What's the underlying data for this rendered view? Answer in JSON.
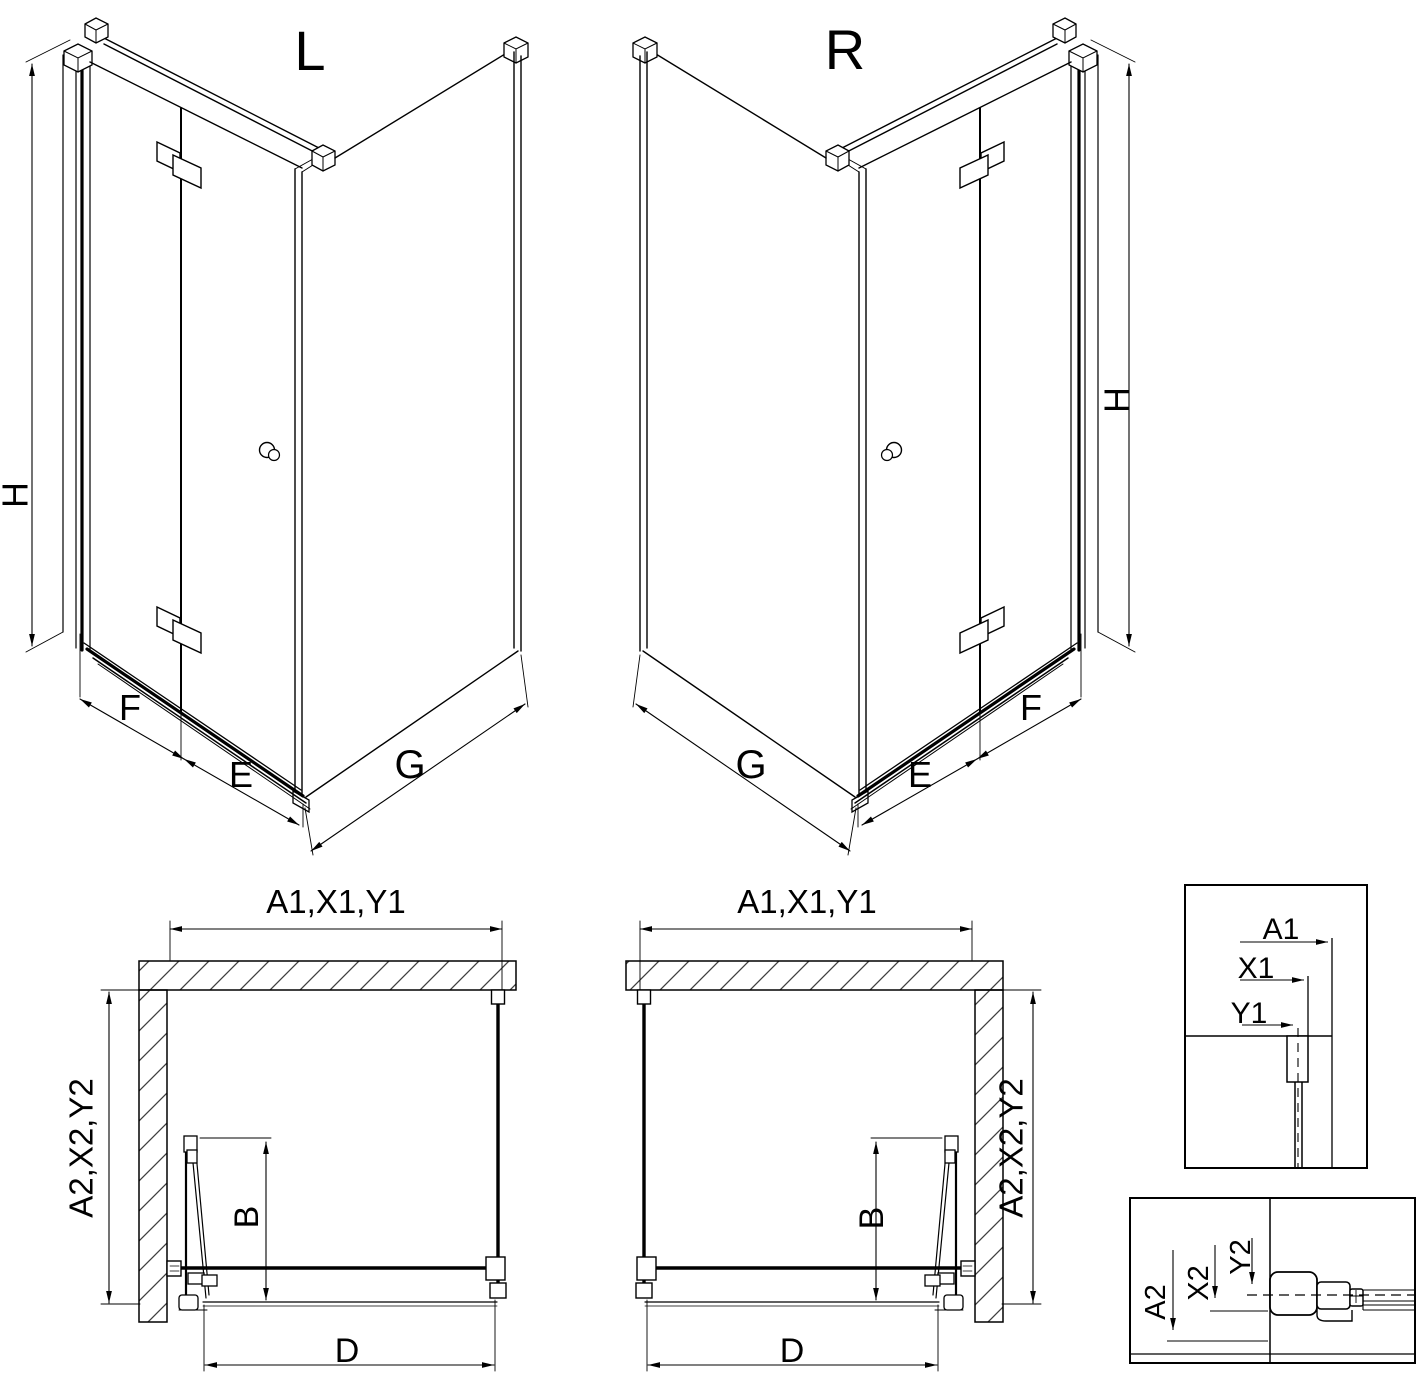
{
  "drawing": {
    "variant_left_title": "L",
    "variant_right_title": "R",
    "iso_labels": {
      "height": "H",
      "door_leaf_front": "F",
      "door_leaf_inner": "E",
      "side_panel": "G"
    },
    "plan_labels": {
      "width_top": "A1,X1,Y1",
      "depth_side": "A2,X2,Y2",
      "door_projection": "B",
      "entry_width": "D"
    },
    "detail_width_labels": {
      "a1": "A1",
      "x1": "X1",
      "y1": "Y1"
    },
    "detail_depth_labels": {
      "a2": "A2",
      "x2": "X2",
      "y2": "Y2"
    }
  },
  "colors": {
    "line": "#000000",
    "hatch": "#3f3f3f",
    "background": "#ffffff"
  }
}
